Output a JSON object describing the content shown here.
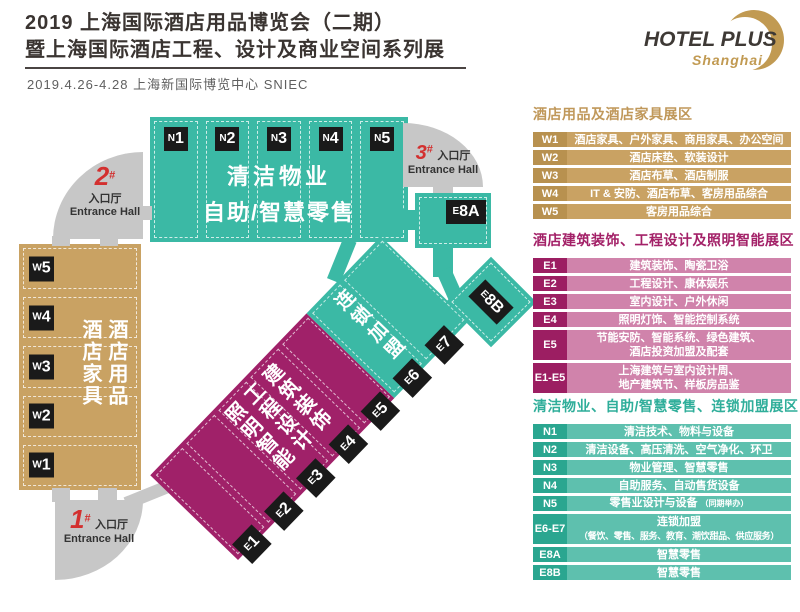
{
  "header": {
    "title_line1": "2019 上海国际酒店用品博览会（二期）",
    "title_line2": "暨上海国际酒店工程、设计及商业空间系列展",
    "date_venue": "2019.4.26-4.28  上海新国际博览中心  SNIEC",
    "logo": {
      "name": "HOTEL PLUS",
      "sub": "Shanghai"
    }
  },
  "colors": {
    "teal": "#3bb9a5",
    "teal_dark": "#2aa690",
    "teal_light": "#5ec0ae",
    "gold": "#c9a263",
    "gold_dark": "#b8914f",
    "magenta": "#a02169",
    "magenta_dark": "#9c1e62",
    "magenta_light": "#d083ab",
    "entrance_gray": "#c7c7c7",
    "entrance_red": "#d3302f",
    "label_black": "#1a1a1a",
    "title_ink": "#3a3431",
    "logo_gold": "#c19a52"
  },
  "map": {
    "n_block": {
      "labels": [
        {
          "p": "N",
          "n": "1"
        },
        {
          "p": "N",
          "n": "2"
        },
        {
          "p": "N",
          "n": "3"
        },
        {
          "p": "N",
          "n": "4"
        },
        {
          "p": "N",
          "n": "5"
        }
      ],
      "line1": "清洁物业",
      "line2": "自助/智慧零售"
    },
    "w_block": {
      "labels": [
        {
          "p": "W",
          "n": "5"
        },
        {
          "p": "W",
          "n": "4"
        },
        {
          "p": "W",
          "n": "3"
        },
        {
          "p": "W",
          "n": "2"
        },
        {
          "p": "W",
          "n": "1"
        }
      ],
      "col_right": "酒店用品",
      "col_left": "酒店家具"
    },
    "strip": {
      "e_labels": [
        {
          "p": "E",
          "n": "1"
        },
        {
          "p": "E",
          "n": "2"
        },
        {
          "p": "E",
          "n": "3"
        },
        {
          "p": "E",
          "n": "4"
        },
        {
          "p": "E",
          "n": "5"
        },
        {
          "p": "E",
          "n": "6"
        },
        {
          "p": "E",
          "n": "7"
        }
      ],
      "teal_text": "连锁加盟",
      "magenta_cols": [
        "建筑装饰",
        "工程设计",
        "照明智能"
      ]
    },
    "e8a": {
      "p": "E",
      "n": "8A"
    },
    "e8b": {
      "p": "E",
      "n": "8B"
    },
    "entrances": [
      {
        "num": "1",
        "hash": "#",
        "cn": "入口厅",
        "en": "Entrance Hall"
      },
      {
        "num": "2",
        "hash": "#",
        "cn": "入口厅",
        "en": "Entrance Hall"
      },
      {
        "num": "3",
        "hash": "#",
        "cn": "入口厅",
        "en": "Entrance Hall"
      }
    ]
  },
  "legend": {
    "sections": [
      {
        "title": "酒店用品及酒店家具展区",
        "rows": [
          {
            "code": "W1",
            "line1": "酒店家具、户外家具、商用家具、办公空间"
          },
          {
            "code": "W2",
            "line1": "酒店床垫、软装设计"
          },
          {
            "code": "W3",
            "line1": "酒店布草、酒店制服"
          },
          {
            "code": "W4",
            "line1": "IT & 安防、酒店布草、客房用品综合"
          },
          {
            "code": "W5",
            "line1": "客房用品综合"
          }
        ]
      },
      {
        "title": "酒店建筑装饰、工程设计及照明智能展区",
        "rows": [
          {
            "code": "E1",
            "line1": "建筑装饰、陶瓷卫浴"
          },
          {
            "code": "E2",
            "line1": "工程设计、康体娱乐"
          },
          {
            "code": "E3",
            "line1": "室内设计、户外休闲"
          },
          {
            "code": "E4",
            "line1": "照明灯饰、智能控制系统"
          },
          {
            "code": "E5",
            "line1": "节能安防、智能系统、绿色建筑、",
            "line2": "酒店投资加盟及配套"
          },
          {
            "code": "E1-E5",
            "line1": "上海建筑与室内设计周、",
            "line2": "地产建筑节、样板房品鉴"
          }
        ]
      },
      {
        "title": "清洁物业、自助/智慧零售、连锁加盟展区",
        "rows": [
          {
            "code": "N1",
            "line1": "清洁技术、物料与设备"
          },
          {
            "code": "N2",
            "line1": "清洁设备、高压清洗、空气净化、环卫"
          },
          {
            "code": "N3",
            "line1": "物业管理、智慧零售"
          },
          {
            "code": "N4",
            "line1": "自助服务、自动售货设备"
          },
          {
            "code": "N5",
            "line1": "零售业设计与设备",
            "note": "（同期举办）"
          },
          {
            "code": "E6-E7",
            "line1": "连锁加盟",
            "line2": "（餐饮、零售、服务、教育、潮饮甜品、供应服务）"
          },
          {
            "code": "E8A",
            "line1": "智慧零售"
          },
          {
            "code": "E8B",
            "line1": "智慧零售"
          }
        ]
      }
    ]
  }
}
